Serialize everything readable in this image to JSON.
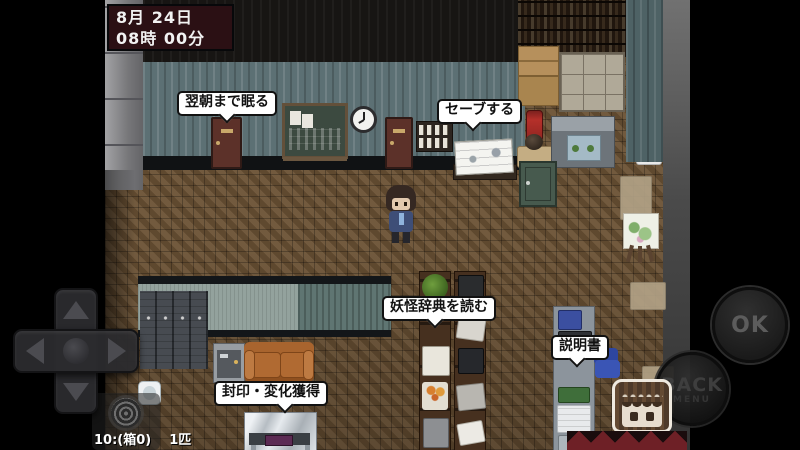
{
  "hud": {
    "date": "8月 24日",
    "time": "08時 00分",
    "counter_count": "10:(箱0)",
    "counter_unit": "1匹"
  },
  "bubbles": {
    "sleep": "翌朝まで眠る",
    "save": "セーブする",
    "dictionary": "妖怪辞典を読む",
    "manual": "説明書",
    "seal": "封印・変化獲得"
  },
  "controls": {
    "ok": "OK",
    "back": "BACK",
    "back_sub": "MENU"
  },
  "colors": {
    "datetime_bg": "#2b1014",
    "bubble_bg": "#ffffff",
    "bubble_text": "#111111",
    "floor_wood": "#6a5134",
    "wallpaper_teal": "#5c7074",
    "sofa_leather": "#b06a32",
    "banner_red": "#6e2026",
    "chair_blue": "#3a55b5",
    "button_label": "#5c5c5c"
  }
}
